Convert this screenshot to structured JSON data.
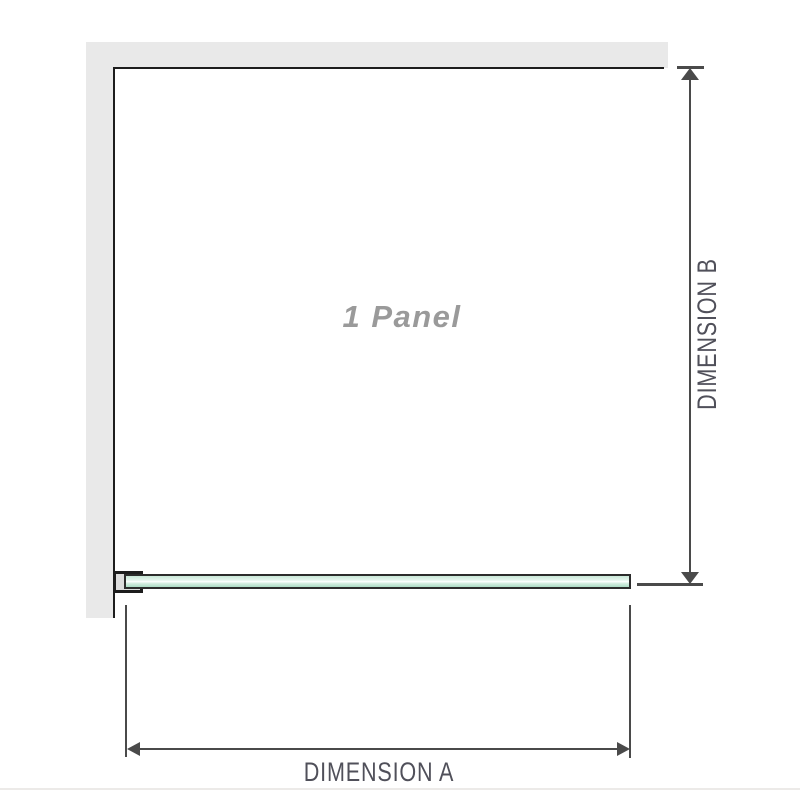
{
  "diagram": {
    "panel_label": "1 Panel",
    "dimension_a": {
      "label": "DIMENSION A"
    },
    "dimension_b": {
      "label": "DIMENSION B"
    }
  },
  "icons": {
    "arrowhead_up": "triangle-up",
    "arrowhead_down": "triangle-down",
    "arrowhead_left": "triangle-left",
    "arrowhead_right": "triangle-right"
  },
  "colors": {
    "wall_gray": "#e9e9e9",
    "outline_dark": "#1d1d1d",
    "dimension_line": "#4a4a4a",
    "dimension_text": "#50505a",
    "panel_label_gray": "#9a9a9a",
    "glass_border": "#2c2c2c",
    "glass_green_light": "#c9e8d7",
    "glass_green_dark": "#abdcc4",
    "divider_light": "#eceae8"
  }
}
